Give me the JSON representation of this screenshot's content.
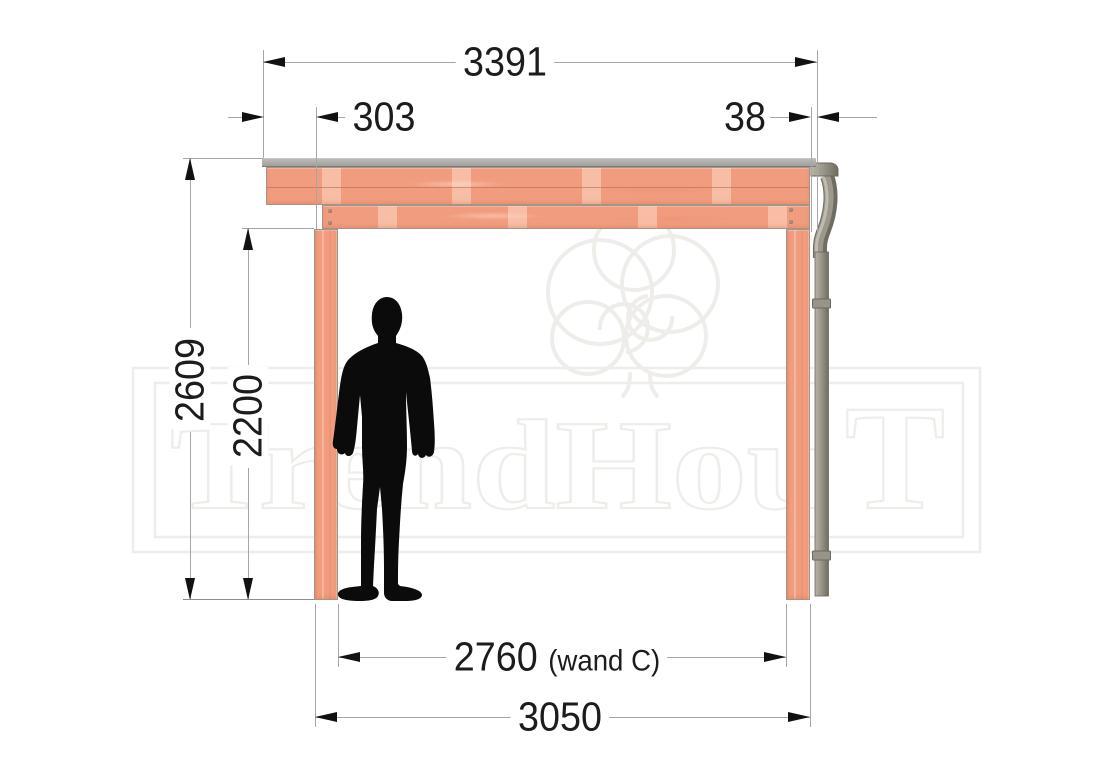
{
  "watermark": {
    "brand": "TrendHout",
    "part1": "TrendHou",
    "part2": "T"
  },
  "dimensions": {
    "roof_width": "3391",
    "left_overhang": "303",
    "right_offset": "38",
    "total_height": "2609",
    "clear_height": "2200",
    "inner_span": "2760",
    "inner_span_note": "(wand C)",
    "outer_span": "3050"
  },
  "colors": {
    "wood": "#f19c7e",
    "wood_grain_light": "#f8c5aa",
    "roof_strip": "#a8a7a3",
    "downpipe": "#97938a",
    "dimension_line": "#a6a6a6",
    "dimension_text": "#1c1c1c",
    "arrow": "#111111",
    "silhouette": "#0b0b0b",
    "watermark_outline": "#efede9"
  }
}
